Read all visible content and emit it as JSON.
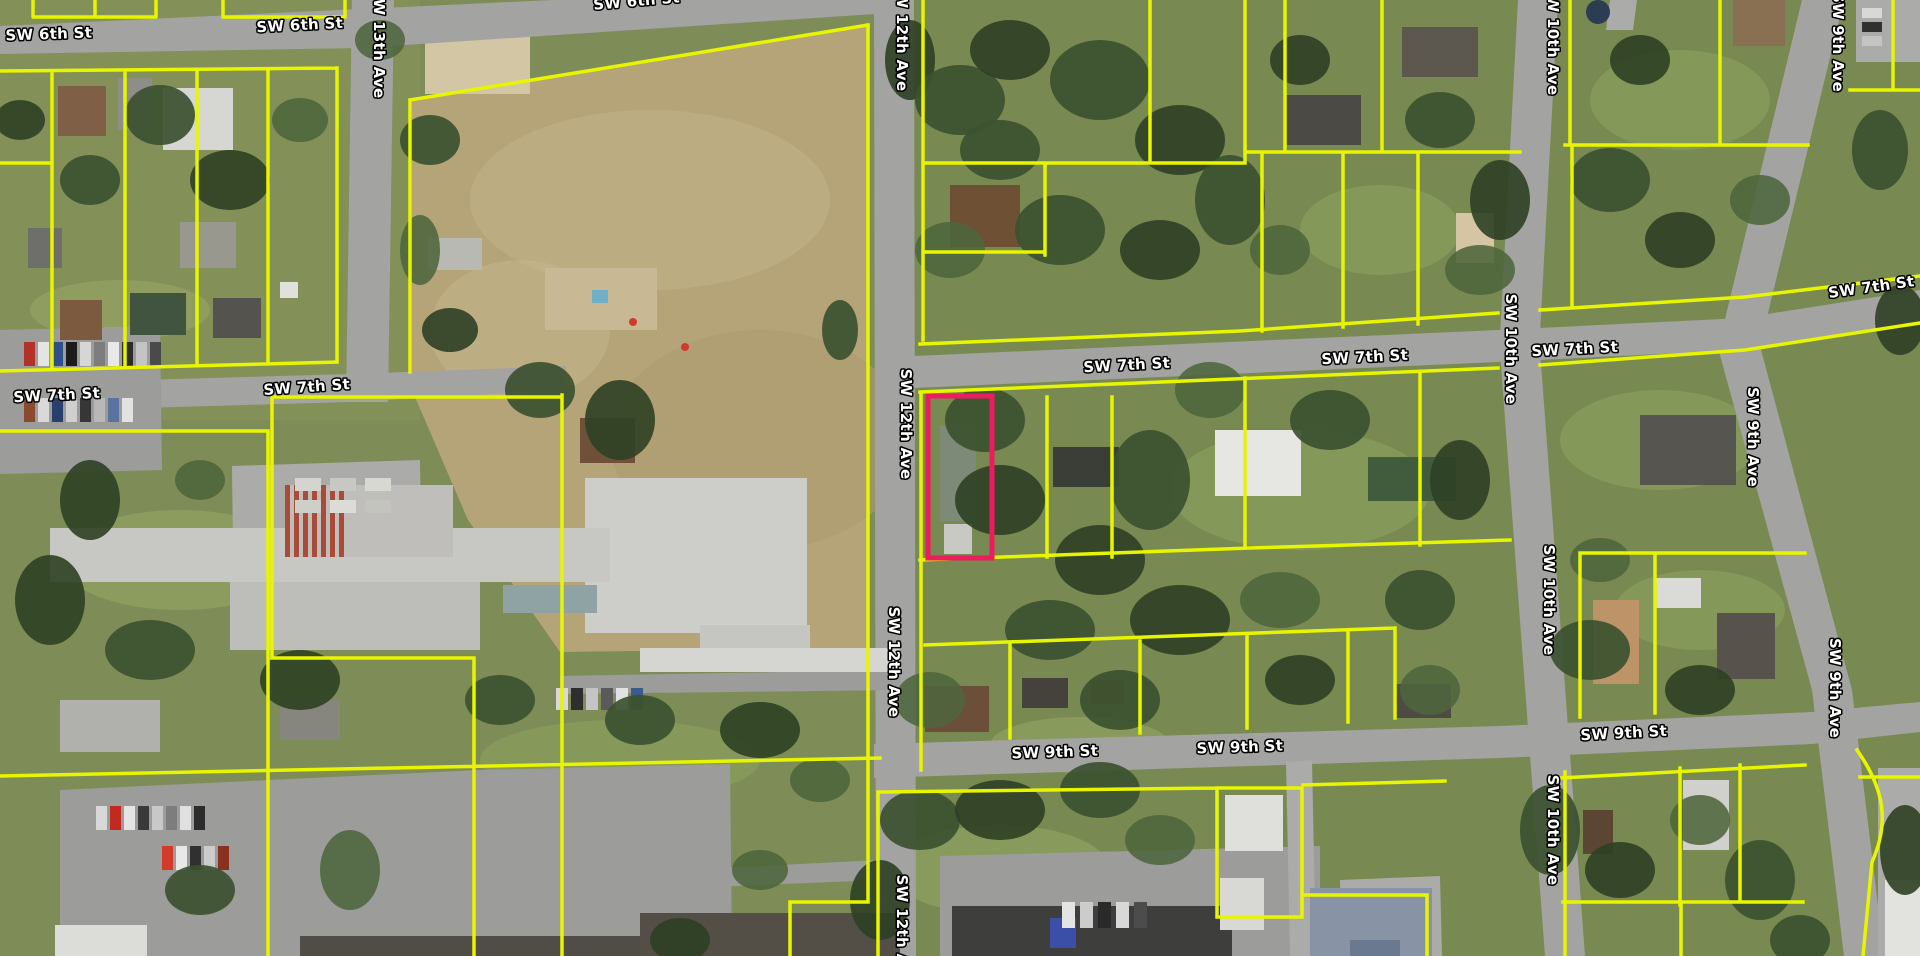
{
  "map": {
    "type": "aerial-parcel-map",
    "imagery": "aerial-orthophoto",
    "parcel_line_color": "#e8f500",
    "label_style": {
      "fill": "#ffffff",
      "outline": "#000000"
    },
    "highlighted_parcel": {
      "x": 928,
      "y": 396,
      "width": 64,
      "height": 162,
      "outline_color": "#ed1c5f"
    },
    "street_labels": [
      {
        "text": "SW 6th St",
        "x": 49,
        "y": 39,
        "rotate": -2
      },
      {
        "text": "SW 6th St",
        "x": 300,
        "y": 30,
        "rotate": -3
      },
      {
        "text": "SW 6th St",
        "x": 637,
        "y": 6,
        "rotate": -5
      },
      {
        "text": "SW 13th Ave",
        "x": 374,
        "y": 43,
        "rotate": 90
      },
      {
        "text": "SW 12th Ave",
        "x": 897,
        "y": 36,
        "rotate": 90
      },
      {
        "text": "SW 12th Ave",
        "x": 901,
        "y": 424,
        "rotate": 90
      },
      {
        "text": "SW 12th Ave",
        "x": 889,
        "y": 662,
        "rotate": 90
      },
      {
        "text": "SW 12th Ave",
        "x": 897,
        "y": 930,
        "rotate": 90
      },
      {
        "text": "SW 7th St",
        "x": 57,
        "y": 400,
        "rotate": -3
      },
      {
        "text": "SW 7th St",
        "x": 307,
        "y": 392,
        "rotate": -4
      },
      {
        "text": "SW 7th St",
        "x": 1127,
        "y": 370,
        "rotate": -3
      },
      {
        "text": "SW 7th St",
        "x": 1365,
        "y": 362,
        "rotate": -3
      },
      {
        "text": "SW 7th St",
        "x": 1575,
        "y": 354,
        "rotate": -3
      },
      {
        "text": "SW 7th St",
        "x": 1872,
        "y": 292,
        "rotate": -8
      },
      {
        "text": "SW 10th Ave",
        "x": 1548,
        "y": 40,
        "rotate": 90
      },
      {
        "text": "SW 10th Ave",
        "x": 1506,
        "y": 349,
        "rotate": 90
      },
      {
        "text": "SW 10th Ave",
        "x": 1544,
        "y": 600,
        "rotate": 90
      },
      {
        "text": "SW 10th Ave",
        "x": 1548,
        "y": 830,
        "rotate": 90
      },
      {
        "text": "SW 9th Ave",
        "x": 1833,
        "y": 42,
        "rotate": 90
      },
      {
        "text": "SW 9th Ave",
        "x": 1748,
        "y": 437,
        "rotate": 90
      },
      {
        "text": "SW 9th Ave",
        "x": 1830,
        "y": 688,
        "rotate": 90
      },
      {
        "text": "SW 9th St",
        "x": 1055,
        "y": 757,
        "rotate": -2
      },
      {
        "text": "SW 9th St",
        "x": 1240,
        "y": 752,
        "rotate": -2
      },
      {
        "text": "SW 9th St",
        "x": 1624,
        "y": 738,
        "rotate": -3
      }
    ]
  }
}
